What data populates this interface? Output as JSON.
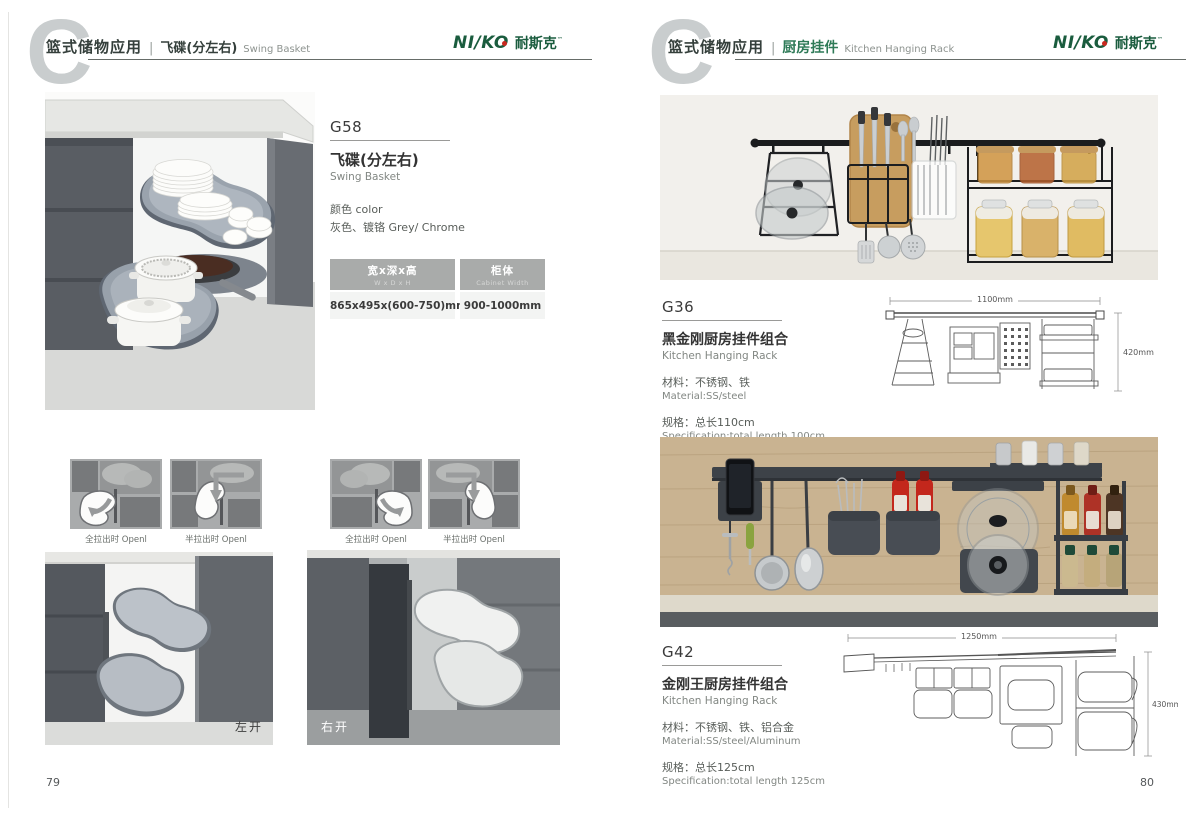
{
  "brand": {
    "logo_latin": "NI/KO",
    "logo_cn": "耐斯克",
    "trademark": "™",
    "green": "#1a5c3e"
  },
  "watermark_letter": "C",
  "left": {
    "page_number": "79",
    "header": {
      "category": "篮式储物应用",
      "separator": "|",
      "title_cn": "飞碟(分左右)",
      "title_en": "Swing Basket"
    },
    "product": {
      "code": "G58",
      "name_cn": "飞碟(分左右)",
      "name_en": "Swing Basket",
      "color_label": "颜色 color",
      "color_value": "灰色、镀铬 Grey/ Chrome",
      "table": {
        "col1_cn": "宽x深x高",
        "col1_en": "W x D x H",
        "col2_cn": "柜体",
        "col2_en": "Cabinet Width",
        "col1_value": "865x495x(600-750)mm",
        "col2_value": "900-1000mm"
      }
    },
    "diagram_captions": [
      "全拉出时 Openl",
      "半拉出时 Openl",
      "全拉出时 Openl",
      "半拉出时 Openl"
    ],
    "photo_caption_left": "左开",
    "photo_caption_right": "右开"
  },
  "right": {
    "page_number": "80",
    "header": {
      "category": "篮式储物应用",
      "separator": "|",
      "title_cn": "厨房挂件",
      "title_en": "Kitchen Hanging Rack"
    },
    "products": [
      {
        "code": "G36",
        "name_cn": "黑金刚厨房挂件组合",
        "name_en": "Kitchen Hanging Rack",
        "material_cn": "材料：不锈钢、铁",
        "material_en": "Material:SS/steel",
        "spec_cn": "规格：总长110cm",
        "spec_en": "Specification:total length 100cm",
        "dim_width": "1100mm",
        "dim_height": "420mm"
      },
      {
        "code": "G42",
        "name_cn": "金刚王厨房挂件组合",
        "name_en": "Kitchen Hanging Rack",
        "material_cn": "材料：不锈钢、铁、铝合金",
        "material_en": "Material:SS/steel/Aluminum",
        "spec_cn": "规格：总长125cm",
        "spec_en": "Specification:total length 125cm",
        "dim_width": "1250mm",
        "dim_height": "430mm"
      }
    ]
  }
}
